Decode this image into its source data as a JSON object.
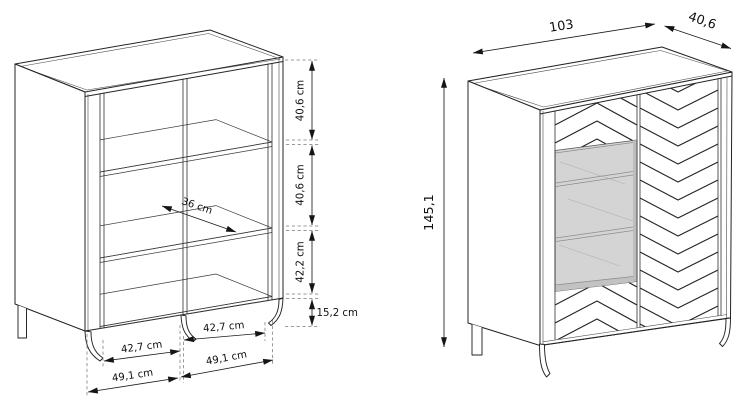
{
  "left_view": {
    "dims": {
      "top_section_height": "40,6 cm",
      "middle_section_height": "40,6 cm",
      "lower_section_height": "42,2 cm",
      "leg_height": "15,2 cm",
      "shelf_depth": "36 cm",
      "inner_width_left": "42,7 cm",
      "inner_width_right": "42,7 cm",
      "outer_width_left": "49,1 cm",
      "outer_width_right": "49,1 cm"
    }
  },
  "right_view": {
    "dims": {
      "width": "103",
      "depth": "40,6",
      "height": "145,1"
    }
  },
  "colors": {
    "line": "#232323",
    "dashed_line": "#7a7a7a",
    "open_compartment_fill": "#d4d4d4",
    "open_compartment_edge": "#bdbdbd",
    "background": "#ffffff"
  }
}
